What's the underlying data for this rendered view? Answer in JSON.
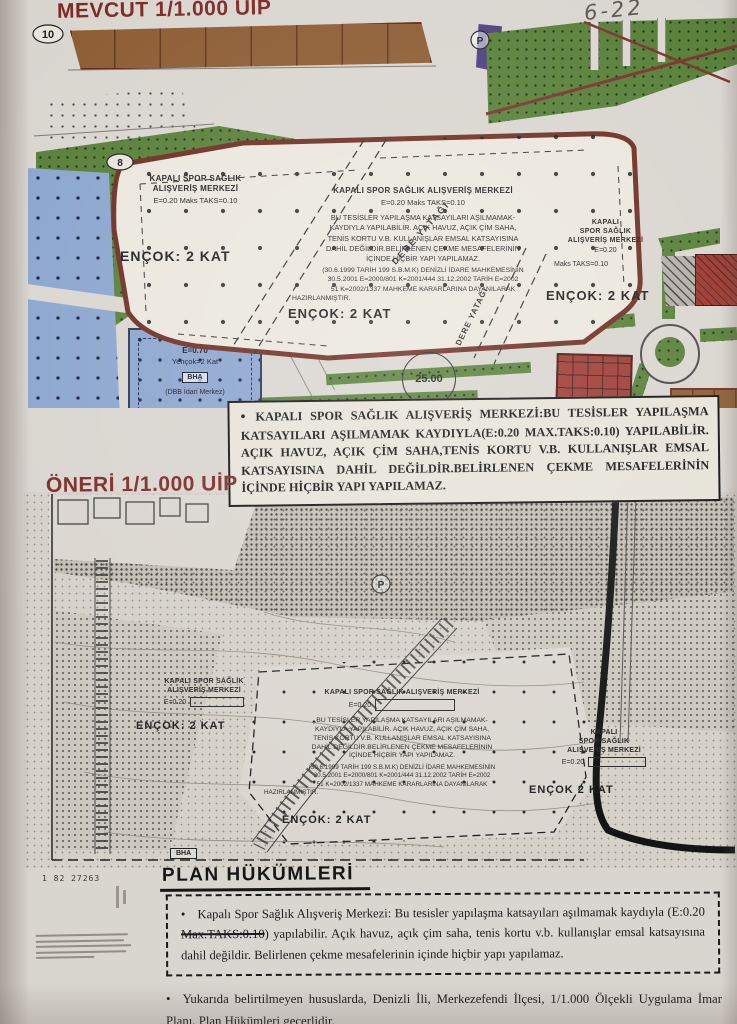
{
  "meta": {
    "handwritten_note": "6-22"
  },
  "colors": {
    "paper": "#d9d5cf",
    "title_maroon": "#7d2827",
    "park_green": "#577f38",
    "zone_blue": "#8ba5ce",
    "building_brown": "#8d5c33",
    "zone_red": "#9c3a32",
    "plot_border": "#6e2d22"
  },
  "map_existing": {
    "title": "MEVCUT 1/1.000 UİP",
    "left_block": {
      "name1": "KAPALI SPOR SAĞLIK",
      "name2": "ALIŞVERİŞ MERKEZİ",
      "coeff": "E=0.20  Maks  TAKS=0.10",
      "floors": "ENÇOK: 2 KAT"
    },
    "center_block": {
      "name": "KAPALI SPOR SAĞLIK ALIŞVERİŞ MERKEZİ",
      "coeff": "E=0.20  Maks  TAKS=0.10",
      "body1": "BU TESİSLER YAPILAŞMA KATSAYILARI AŞILMAMAK-",
      "body2": "KAYDIYLA YAPILABİLİR. AÇIK HAVUZ, AÇIK ÇİM SAHA,",
      "body3": "TENİS KORTU V.B. KULLANIŞLAR EMSAL KATSAYISINA",
      "body4": "DAHİL DEĞİLDİR.BELİRLENEN ÇEKME MESAFELERİNİN",
      "body5": "İÇİNDE HİÇBİR YAPI YAPILAMAZ.",
      "court1": "(30.6.1999 TARİH 199 S.B.M.K) DENİZLİ İDARE  MAHKEMESİNİN",
      "court2": "30.5.2001 E=2000/801 K=2001/444  31.12.2002 TARİH E=2002",
      "court3": "51 K=2002/1337 MAHKEME KARARLARINA DAYANILARAK",
      "court4": "HAZIRLANMIŞTIR.",
      "floors": "ENÇOK: 2 KAT"
    },
    "right_block": {
      "name1": "KAPALI",
      "name2": "SPOR SAĞLIK",
      "name3": "ALIŞVERİŞ MERKEZİ",
      "coeff1": "E=0.20",
      "coeff2": "Maks TAKS=0.10",
      "floors": "ENÇOK: 2 KAT"
    },
    "blue_parcel": {
      "coeff": "E=0.70",
      "floors": "Yençok=2 Kat",
      "code": "BHA",
      "note": "(DBB İdari Merkez)"
    },
    "creek_label1": "DERE YATAĞI",
    "creek_label2": "DERE YATAĞI",
    "road_width_label": "25.00",
    "marker_10": "10",
    "marker_8": "8",
    "marker_p": "P"
  },
  "note_box": {
    "text": "KAPALI SPOR SAĞLIK ALIŞVERİŞ MERKEZİ:BU TESİSLER YAPILAŞMA KATSAYILARI AŞILMAMAK KAYDIYLA(E:0.20 MAX.TAKS:0.10) YAPILABİLİR. AÇIK HAVUZ, AÇIK ÇİM SAHA,TENİS KORTU V.B. KULLANIŞLAR EMSAL KATSAYISINA DAHİL DEĞİLDİR.BELİRLENEN ÇEKME MESAFELERİNİN İÇİNDE HİÇBİR YAPI YAPILAMAZ."
  },
  "map_proposed": {
    "title": "ÖNERİ 1/1.000 UİP",
    "left_block": {
      "name1": "KAPALI SPOR SAĞLIK",
      "name2": "ALIŞVERİŞ MERKEZİ",
      "coeff": "E=0.20",
      "floors": "ENÇOK: 2 KAT"
    },
    "center_block": {
      "name": "KAPALI SPOR SAĞLIK ALIŞVERİŞ MERKEZİ",
      "coeff": "E=0.20",
      "body1": "BU TESİSLER YAPILAŞMA KATSAYILARI AŞILMAMAK-",
      "body2": "KAYDIYLA YAPILABİLİR. AÇIK HAVUZ, AÇIK ÇİM SAHA,",
      "body3": "TENİS KORTU V.B. KULLANIŞLAR EMSAL KATSAYISINA",
      "body4": "DAHİL DEĞİLDİR.BELİRLENEN ÇEKME MESAFELERİNİN",
      "body5": "İÇİNDE HİÇBİR YAPI YAPILAMAZ.",
      "court1": "(30.6.1999 TARİH 199 S.B.M.K) DENİZLİ İDARE  MAHKEMESİNİN",
      "court2": "30.5.2001 E=2000/801 K=2001/444  31.12.2002 TARİH E=2002",
      "court3": "51 K=2002/1337 MAHKEME KARARLARINA DAYANILARAK",
      "court4": "HAZIRLANMIŞTIR.",
      "floors": "ENÇOK: 2 KAT"
    },
    "right_block": {
      "name1": "KAPALI",
      "name2": "SPOR SAĞLIK",
      "name3": "ALIŞVERİŞ MERKEZİ",
      "coeff": "E=0.20",
      "floors": "ENÇOK 2 KAT"
    },
    "bha_label": "BHA",
    "marker_p": "P",
    "scale_note": "1 82 27263"
  },
  "plan_provisions": {
    "heading": "PLAN HÜKÜMLERİ",
    "item1_pre": "Kapalı Spor Sağlık Alışveriş Merkezi: Bu tesisler yapılaşma katsayıları aşılmamak kaydıyla (E:0.20 ",
    "item1_struck": "Max.TAKS:0.10",
    "item1_post": ") yapılabilir. Açık havuz, açık çim saha, tenis kortu v.b. kullanışlar emsal katsayısına dahil değildir. Belirlenen çekme mesafelerinin içinde hiçbir yapı yapılamaz.",
    "item2": "Yukarıda belirtilmeyen hususlarda, Denizli İli, Merkezefendi İlçesi, 1/1.000 Ölçekli Uygulama İmar Planı, Plan Hükümleri geçerlidir."
  }
}
